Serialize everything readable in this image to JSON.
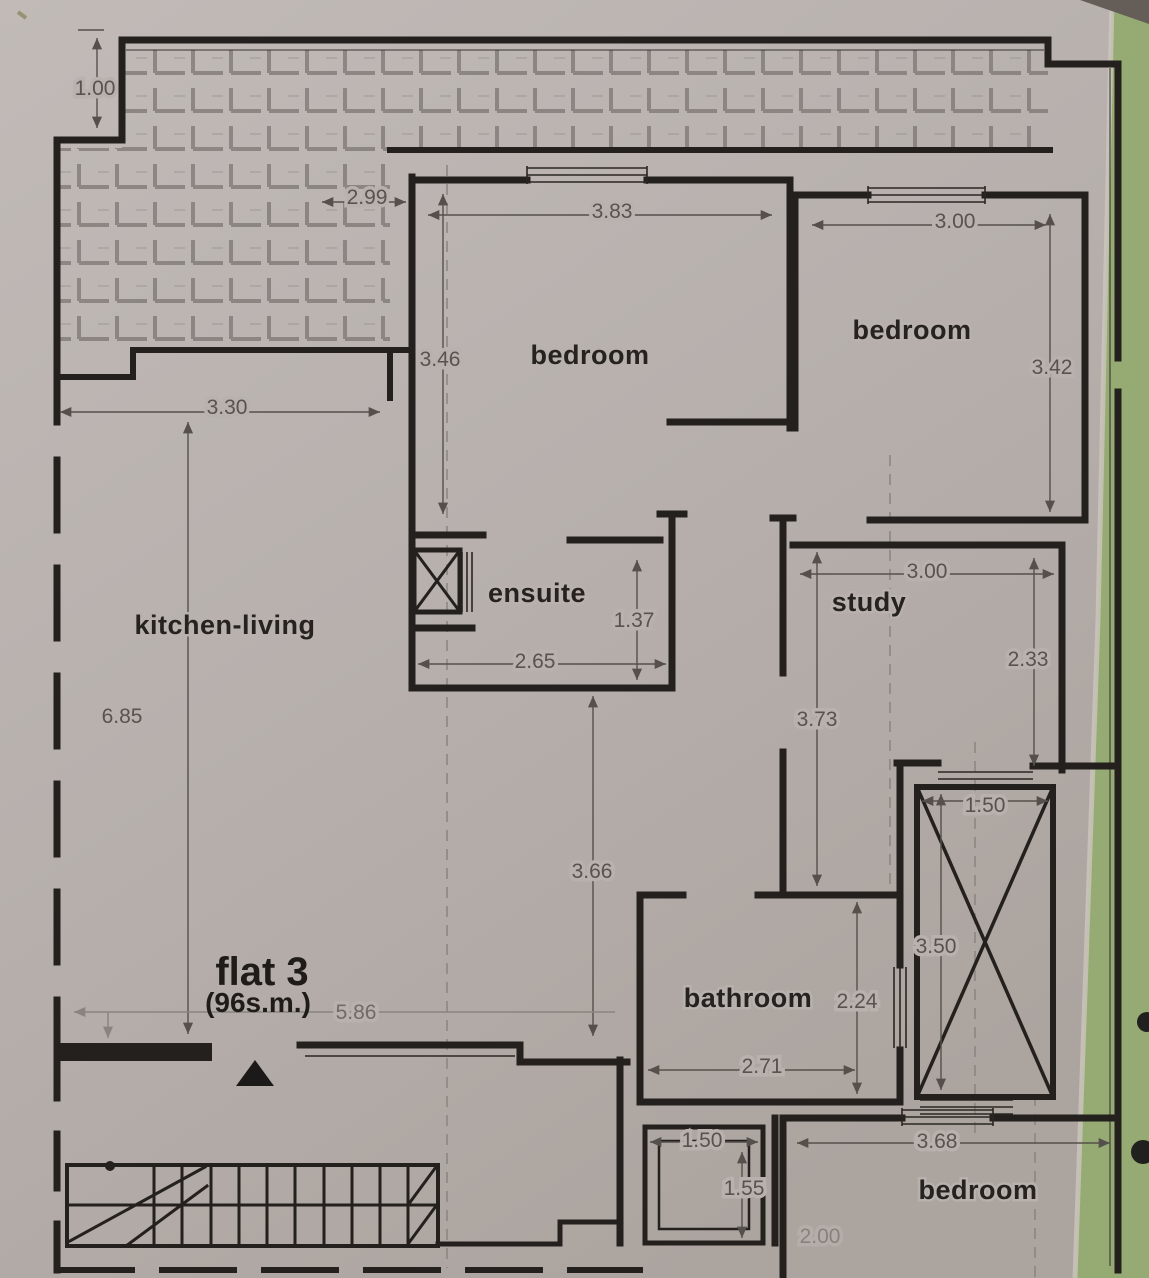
{
  "title": "flat 3 floor plan",
  "plan": {
    "flat": {
      "name": "flat 3",
      "area": "(96s.m.)"
    },
    "rooms": {
      "kitchen_living": "kitchen-living",
      "bedroom_main": "bedroom",
      "bedroom_right": "bedroom",
      "bedroom_bottom": "bedroom",
      "ensuite": "ensuite",
      "study": "study",
      "bathroom": "bathroom"
    },
    "dimensions": {
      "terrace_depth": "1.00",
      "terrace_width": "2.99",
      "bedroom_main_width": "3.83",
      "bedroom_main_depth": "3.46",
      "bedroom_right_width": "3.00",
      "bedroom_right_depth": "3.42",
      "kitchen_width": "3.30",
      "kitchen_depth": "6.85",
      "ensuite_width": "2.65",
      "ensuite_depth": "1.37",
      "study_width": "3.00",
      "study_depth_right": "2.33",
      "study_depth_left": "3.73",
      "hall_depth": "3.66",
      "lift_width": "1.50",
      "lift_depth": "3.50",
      "bathroom_depth": "2.24",
      "bathroom_width": "2.71",
      "living_width": "5.86",
      "duct_width": "1.50",
      "duct_depth": "1.55",
      "bedroom_bottom_width": "3.68",
      "partial_bottom": "2.00"
    },
    "colors": {
      "paper": "#b8b1ae",
      "backdrop_green": "#96aa73",
      "wall": "#23201e",
      "dim_text": "#59524e",
      "tile_line": "#7e7773"
    }
  }
}
